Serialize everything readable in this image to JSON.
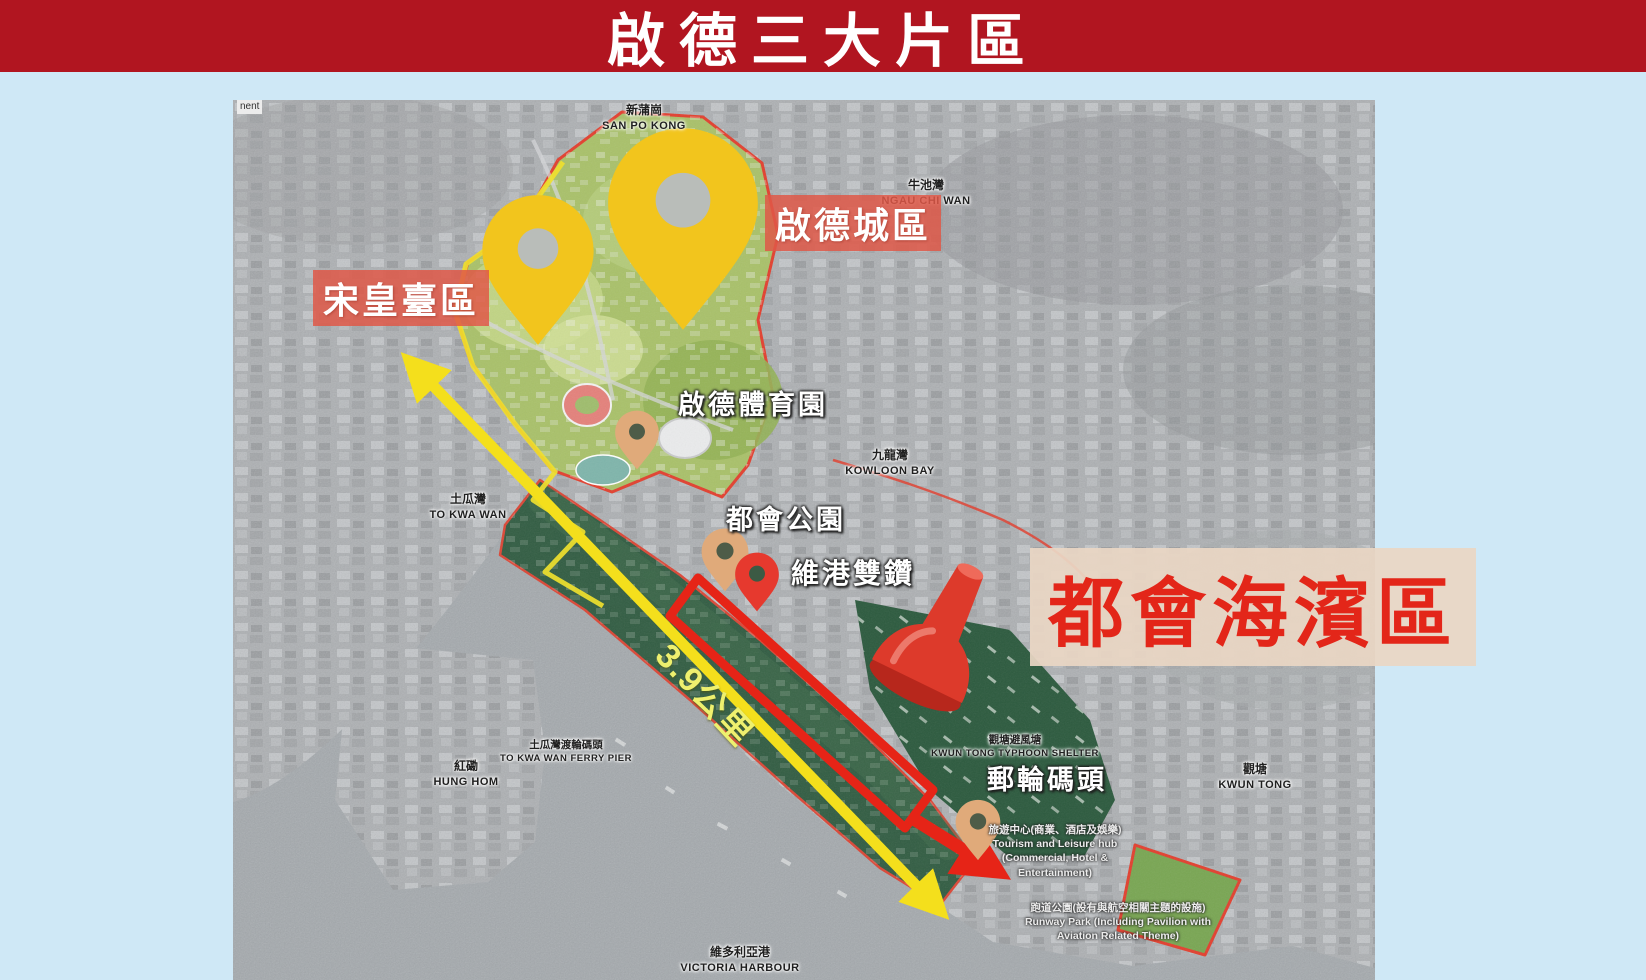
{
  "banner": {
    "title": "啟德三大片區"
  },
  "labels": {
    "sung_wong_toi": "宋皇臺區",
    "kai_tak_city": "啟德城區",
    "metro_waterfront": "都會海濱區",
    "sports_park": "啟德體育園",
    "metro_park": "都會公園",
    "twin_diamonds": "維港雙鑽",
    "cruise_terminal": "郵輪碼頭",
    "distance": "3.9公里"
  },
  "districts": {
    "san_po_kong": {
      "zh": "新蒲崗",
      "en": "SAN PO KONG"
    },
    "ngau_chi_wan": {
      "zh": "牛池灣",
      "en": "NGAU CHI WAN"
    },
    "kowloon_bay": {
      "zh": "九龍灣",
      "en": "KOWLOON BAY"
    },
    "to_kwa_wan": {
      "zh": "土瓜灣",
      "en": "TO KWA WAN"
    },
    "hung_hom": {
      "zh": "紅磡",
      "en": "HUNG HOM"
    },
    "kwun_tong": {
      "zh": "觀塘",
      "en": "KWUN TONG"
    },
    "victoria_harbour": {
      "zh": "維多利亞港",
      "en": "VICTORIA HARBOUR"
    },
    "typhoon_shelter": {
      "zh": "觀塘避風塘",
      "en": "KWUN TONG TYPHOON SHELTER"
    },
    "ferry_pier": {
      "zh": "土瓜灣渡輪碼頭",
      "en": "TO KWA WAN FERRY PIER"
    }
  },
  "annotations": {
    "tourism_hub": {
      "zh": "旅遊中心(商業、酒店及娛樂)",
      "en": "Tourism and Leisure hub (Commercial, Hotel & Entertainment)"
    },
    "runway_park": {
      "zh": "跑道公園(設有與航空相關主題的設施)",
      "en": "Runway Park (Including Pavilion with Aviation Related Theme)"
    }
  },
  "fragment": "nent",
  "colors": {
    "page_bg": "#cfe8f6",
    "banner_bg": "#b11520",
    "banner_text": "#ffffff",
    "region_label_bg": "#df584b",
    "region_label_text": "#ffffff",
    "headline_bg": "#e9d6c4",
    "headline_text": "#e32619",
    "pin_yellow": "#f2c51d",
    "pin_tan": "#e0aa7a",
    "pin_red": "#e6392e",
    "pushpin_red": "#dd3a2b",
    "arrow_yellow": "#f4df1c",
    "measure_red": "#e62417",
    "dev_green_light": "#a9c16a",
    "dev_green_dark": "#2f5b40",
    "water_gray": "#a4a9ad",
    "city_gray": "#aeb1b4"
  }
}
